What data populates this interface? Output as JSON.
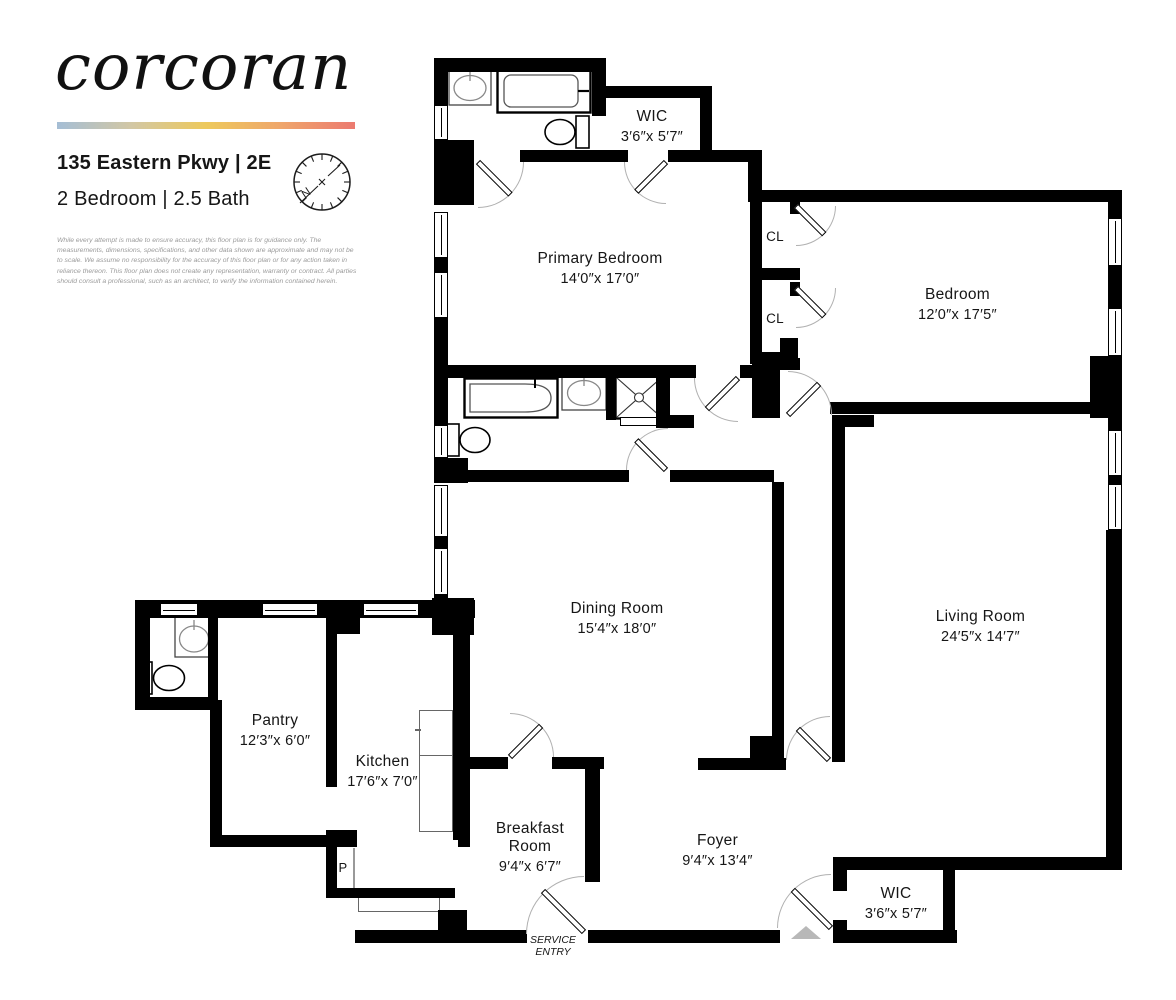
{
  "header": {
    "brand": "corcoran",
    "address": "135 Eastern Pkwy | 2E",
    "unit_info": "2 Bedroom | 2.5 Bath",
    "disclaimer": "While every attempt is made to ensure accuracy, this floor plan is for guidance only. The measurements, dimensions, specifications, and other data shown are approximate and may not be to scale. We assume no responsibility for the accuracy of this floor plan or for any action taken in reliance thereon. This floor plan does not create any representation, warranty or contract. All parties should consult a professional, such as an architect, to verify the information contained herein.",
    "compass_north_label": "N",
    "accent_gradient": [
      "#a5bed5",
      "#d2c7a4",
      "#edc95c",
      "#efa66b",
      "#ec7a70"
    ]
  },
  "plan": {
    "wall_color": "#000000",
    "rooms": {
      "wic_top": {
        "name": "WIC",
        "dims": "3′6″x 5′7″"
      },
      "primary_bedroom": {
        "name": "Primary Bedroom",
        "dims": "14′0″x 17′0″"
      },
      "bedroom": {
        "name": "Bedroom",
        "dims": "12′0″x 17′5″"
      },
      "dining_room": {
        "name": "Dining Room",
        "dims": "15′4″x 18′0″"
      },
      "living_room": {
        "name": "Living Room",
        "dims": "24′5″x 14′7″"
      },
      "pantry": {
        "name": "Pantry",
        "dims": "12′3″x 6′0″"
      },
      "kitchen": {
        "name": "Kitchen",
        "dims": "17′6″x 7′0″"
      },
      "breakfast_room": {
        "name": "Breakfast Room",
        "dims": "9′4″x 6′7″"
      },
      "foyer": {
        "name": "Foyer",
        "dims": "9′4″x 13′4″"
      },
      "wic_bottom": {
        "name": "WIC",
        "dims": "3′6″x 5′7″"
      }
    },
    "labels": {
      "closet_upper": "CL",
      "closet_lower": "CL",
      "pipe": "P"
    },
    "service_entry": {
      "line1": "SERVICE",
      "line2": "ENTRY"
    }
  }
}
